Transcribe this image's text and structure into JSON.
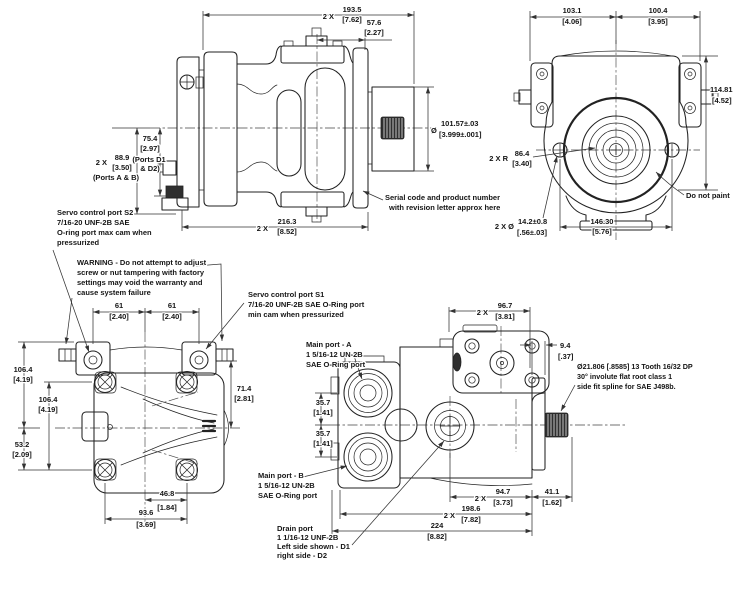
{
  "side": {
    "d1935": {
      "p": "2 X",
      "mm": "193.5",
      "in": "[7.62]"
    },
    "d576": {
      "mm": "57.6",
      "in": "[2.27]"
    },
    "d889": {
      "p": "2 X",
      "mm": "88.9",
      "in": "[3.50]",
      "l1": "(Ports A & B)"
    },
    "d754": {
      "mm": "75.4",
      "in": "[2.97]",
      "l1": "(Ports D1",
      "l2": "& D2)"
    },
    "d1016": {
      "sym": "Ø",
      "mm": "101.57±.03",
      "in": "[3.999±.001]"
    },
    "serial": {
      "l1": "Serial code and product number",
      "l2": "with revision letter approx here"
    },
    "d2163": {
      "p": "2 X",
      "mm": "216.3",
      "in": "[8.52]"
    }
  },
  "rear": {
    "d1031": {
      "mm": "103.1",
      "in": "[4.06]"
    },
    "d1004": {
      "mm": "100.4",
      "in": "[3.95]"
    },
    "d11481": {
      "mm": "114.81",
      "in": "[4.52]"
    },
    "r864": {
      "p": "2 X R",
      "mm": "86.4",
      "in": "[3.40]"
    },
    "d142": {
      "p": "2 X Ø",
      "mm": "14.2±0.8",
      "in": "[.56±.03]"
    },
    "d1463": {
      "mm": "146.30",
      "in": "[5.76]"
    },
    "paint": "Do not paint"
  },
  "top": {
    "s2": {
      "l1": "Servo control port S2",
      "l2": "7/16-20 UNF-2B SAE",
      "l3": "O-ring port max cam when",
      "l4": "pressurized"
    },
    "warning": {
      "l1": "WARNING - Do not attempt to adjust",
      "l2": "screw or nut tampering with factory",
      "l3": "settings may void the warranty and",
      "l4": "cause system failure"
    },
    "d61L": {
      "mm": "61",
      "in": "[2.40]"
    },
    "d61R": {
      "mm": "61",
      "in": "[2.40]"
    },
    "d1064a": {
      "mm": "106.4",
      "in": "[4.19]"
    },
    "d1064b": {
      "mm": "106.4",
      "in": "[4.19]"
    },
    "d532": {
      "mm": "53.2",
      "in": "[2.09]"
    },
    "d714": {
      "mm": "71.4",
      "in": "[2.81]"
    },
    "d468": {
      "mm": "46.8",
      "in": "[1.84]"
    },
    "d936": {
      "mm": "93.6",
      "in": "[3.69]"
    }
  },
  "bottom": {
    "s1": {
      "l1": "Servo control port S1",
      "l2": "7/16-20 UNF-2B SAE O-Ring port",
      "l3": "min cam when pressurized"
    },
    "portA": {
      "l1": "Main port - A",
      "l2": "1 5/16-12 UN-2B",
      "l3": "SAE O-Ring port"
    },
    "portB": {
      "l1": "Main port - B",
      "l2": "1 5/16-12 UN-2B",
      "l3": "SAE O-Ring port"
    },
    "drain": {
      "l1": "Drain port",
      "l2": "1 1/16-12 UNF-2B",
      "l3": "Left side shown - D1",
      "l4": "right side - D2"
    },
    "spline": {
      "l1": "Ø21.806 [.8585] 13 Tooth 16/32 DP",
      "l2": "30° involute flat root class 1",
      "l3": "side fit spline for SAE J498b."
    },
    "d967": {
      "p": "2 X",
      "mm": "96.7",
      "in": "[3.81]"
    },
    "d94": {
      "mm": "9.4",
      "in": "[.37]"
    },
    "d357a": {
      "mm": "35.7",
      "in": "[1.41]"
    },
    "d357b": {
      "mm": "35.7",
      "in": "[1.41]"
    },
    "d947": {
      "p": "2 X",
      "mm": "94.7",
      "in": "[3.73]"
    },
    "d411": {
      "mm": "41.1",
      "in": "[1.62]"
    },
    "d1986": {
      "p": "2 X",
      "mm": "198.6",
      "in": "[7.82]"
    },
    "d224": {
      "mm": "224",
      "in": "[8.82]"
    }
  }
}
